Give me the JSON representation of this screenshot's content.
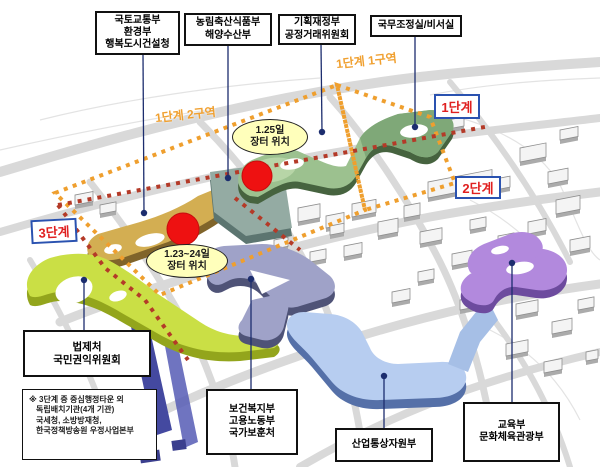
{
  "ministries": {
    "molit": [
      "국토교통부",
      "환경부",
      "행복도시건설청"
    ],
    "mafra": [
      "농림축산식품부",
      "해양수산부"
    ],
    "moef": [
      "기획재정부",
      "공정거래위원회"
    ],
    "osc": [
      "국무조정실/비서실"
    ],
    "moleg": [
      "법제처",
      "국민권익위원회"
    ],
    "mohw": [
      "보건복지부",
      "고용노동부",
      "국가보훈처"
    ],
    "motie": [
      "산업통상자원부"
    ],
    "moe": [
      "교육부",
      "문화체육관광부"
    ]
  },
  "phases": {
    "p1": "1단계",
    "p2": "2단계",
    "p3": "3단계"
  },
  "zones": {
    "zone1": "1단계 1구역",
    "zone2": "1단계 2구역"
  },
  "markets": {
    "jan25": [
      "1.25일",
      "장터 위치"
    ],
    "jan2324": [
      "1.23~24일",
      "장터 위치"
    ]
  },
  "note": [
    "※ 3단계 중 중심행정타운 외",
    "독립배치기관(4개 기관)",
    "국세청, 소방방재청,",
    "한국정책방송원 우정사업본부"
  ],
  "colors": {
    "phase1_ribbon": "#9cc18f",
    "phase1_ribbon_dark": "#46633f",
    "plaza": "#94aba3",
    "tan_ribbon": "#d3ae52",
    "phase3_ribbon": "#cadf45",
    "lavender_ribbon": "#9fa2c8",
    "blue_ribbon": "#b7cdf0",
    "purple_ribbon": "#b289dd",
    "zone_dots": "#ef9f2e",
    "phase2_dots": "#b43a28",
    "marker_red": "#ee1111",
    "connector_navy": "#1c2d6e",
    "badge_text": "#e02020",
    "badge_border": "#2a52b0"
  }
}
